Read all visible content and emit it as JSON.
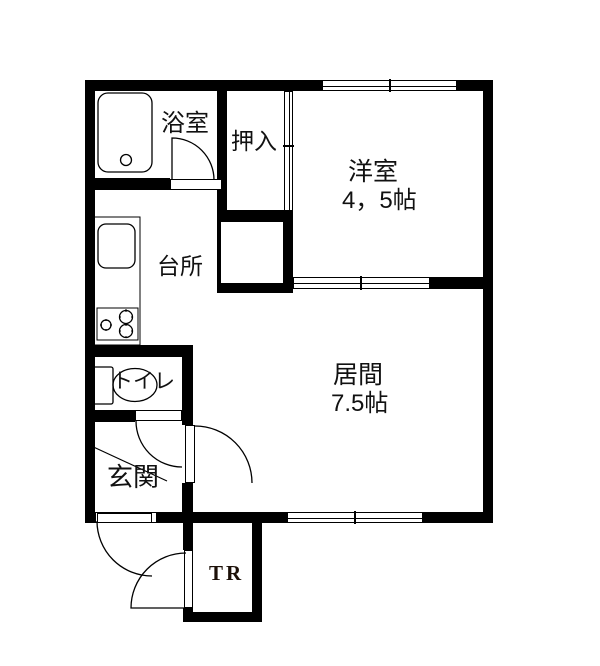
{
  "floor_plan": {
    "rooms": {
      "bathroom": {
        "label": "浴室"
      },
      "closet": {
        "label": "押入"
      },
      "western_room": {
        "label": "洋室",
        "size": "4，5帖"
      },
      "kitchen": {
        "label": "台所"
      },
      "toilet": {
        "label": "トイレ"
      },
      "entrance": {
        "label": "玄関"
      },
      "living_room": {
        "label": "居間",
        "size": "7.5帖"
      },
      "trunk_room": {
        "label": "TR"
      }
    },
    "icons": [
      "bathtub-icon",
      "sink-icon",
      "stove-icon",
      "toilet-icon",
      "door-swing-arc",
      "window-symbol",
      "sliding-door-symbol"
    ],
    "colors": {
      "wall": "#000000",
      "background": "#ffffff",
      "text": "#111111",
      "trunk_label": "#1c1008"
    }
  }
}
